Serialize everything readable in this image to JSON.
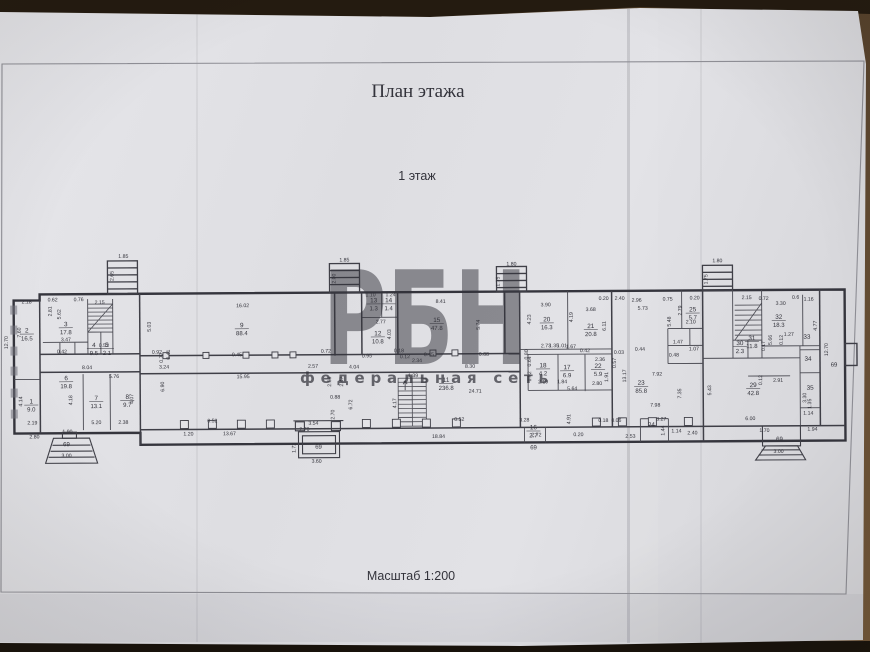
{
  "page": {
    "title": "План этажа",
    "floor_label": "1 этаж",
    "scale_label": "Масштаб 1:200"
  },
  "watermark": {
    "text": "РБН",
    "subtext": "федеральная сеть",
    "color": "#c84e4e"
  },
  "colors": {
    "ink": "#33333b",
    "wall": "#3f3f47",
    "paper": "#e3e3e7"
  },
  "plan": {
    "rooms": [
      {
        "n": "1",
        "a": "9.0",
        "x": 31,
        "y": 401
      },
      {
        "n": "2",
        "a": "16.5",
        "x": 27,
        "y": 330
      },
      {
        "n": "3",
        "a": "17.8",
        "x": 66,
        "y": 324
      },
      {
        "n": "4",
        "a": "9.5",
        "x": 94,
        "y": 345
      },
      {
        "n": "5",
        "a": "2.1",
        "x": 107,
        "y": 345
      },
      {
        "n": "6",
        "a": "19.8",
        "x": 66,
        "y": 378
      },
      {
        "n": "7",
        "a": "13.1",
        "x": 96,
        "y": 398
      },
      {
        "n": "8",
        "a": "9.7",
        "x": 127,
        "y": 397
      },
      {
        "n": "9",
        "a": "88.4",
        "x": 242,
        "y": 326
      },
      {
        "n": "11",
        "a": "236.8",
        "x": 446,
        "y": 382
      },
      {
        "n": "12",
        "a": "10.8",
        "x": 378,
        "y": 335
      },
      {
        "n": "13",
        "a": "1.3",
        "x": 374,
        "y": 302
      },
      {
        "n": "14",
        "a": "1.4",
        "x": 389,
        "y": 302
      },
      {
        "n": "15",
        "a": "47.8",
        "x": 437,
        "y": 322
      },
      {
        "n": "16",
        "a": "2.7",
        "x": 533,
        "y": 430
      },
      {
        "n": "17",
        "a": "6.9",
        "x": 567,
        "y": 370
      },
      {
        "n": "18",
        "a": "4.2",
        "x": 543,
        "y": 368
      },
      {
        "n": "20",
        "a": "16.3",
        "x": 547,
        "y": 322
      },
      {
        "n": "21",
        "a": "20.8",
        "x": 591,
        "y": 329
      },
      {
        "n": "22",
        "a": "5.9",
        "x": 598,
        "y": 369
      },
      {
        "n": "23",
        "a": "85.8",
        "x": 641,
        "y": 386
      },
      {
        "n": "24",
        "a": "",
        "x": 651,
        "y": 428
      },
      {
        "n": "25",
        "a": "5.7",
        "x": 693,
        "y": 313
      },
      {
        "n": "29",
        "a": "42.8",
        "x": 753,
        "y": 389
      },
      {
        "n": "30",
        "a": "2.3",
        "x": 740,
        "y": 347
      },
      {
        "n": "31",
        "a": "11.8",
        "x": 752,
        "y": 342
      },
      {
        "n": "32",
        "a": "18.3",
        "x": 779,
        "y": 321
      },
      {
        "n": "33",
        "a": "",
        "x": 807,
        "y": 341
      },
      {
        "n": "34",
        "a": "",
        "x": 808,
        "y": 363
      },
      {
        "n": "35",
        "a": "",
        "x": 810,
        "y": 392
      }
    ],
    "entrances": [
      {
        "t": "69",
        "x": 66,
        "y": 444
      },
      {
        "t": "69",
        "x": 318,
        "y": 448
      },
      {
        "t": "69",
        "x": 533,
        "y": 450
      },
      {
        "t": "69",
        "x": 779,
        "y": 443
      },
      {
        "t": "69",
        "x": 834,
        "y": 369
      }
    ],
    "dimensions": [
      {
        "t": "1.85",
        "x": 124,
        "y": 256
      },
      {
        "t": "2.65",
        "x": 114,
        "y": 274,
        "r": 1
      },
      {
        "t": "1.85",
        "x": 345,
        "y": 261
      },
      {
        "t": "2.00",
        "x": 336,
        "y": 278,
        "r": 1
      },
      {
        "t": "1.80",
        "x": 512,
        "y": 266
      },
      {
        "t": "1.75",
        "x": 500,
        "y": 282,
        "r": 1
      },
      {
        "t": "1.80",
        "x": 718,
        "y": 264
      },
      {
        "t": "1.75",
        "x": 708,
        "y": 281,
        "r": 1
      },
      {
        "t": "2.18",
        "x": 27,
        "y": 301
      },
      {
        "t": "0.62",
        "x": 53,
        "y": 299
      },
      {
        "t": "0.76",
        "x": 79,
        "y": 299
      },
      {
        "t": "2.15",
        "x": 100,
        "y": 302
      },
      {
        "t": "16.02",
        "x": 243,
        "y": 306
      },
      {
        "t": "8.41",
        "x": 441,
        "y": 303
      },
      {
        "t": "3.90",
        "x": 546,
        "y": 307
      },
      {
        "t": "3.68",
        "x": 591,
        "y": 312
      },
      {
        "t": "0.20",
        "x": 604,
        "y": 301
      },
      {
        "t": "2.40",
        "x": 620,
        "y": 301
      },
      {
        "t": "2.96",
        "x": 637,
        "y": 303
      },
      {
        "t": "0.75",
        "x": 668,
        "y": 302
      },
      {
        "t": "0.20",
        "x": 695,
        "y": 301
      },
      {
        "t": "2.15",
        "x": 747,
        "y": 301
      },
      {
        "t": "0.72",
        "x": 764,
        "y": 302
      },
      {
        "t": "3.30",
        "x": 781,
        "y": 307
      },
      {
        "t": "0.6",
        "x": 796,
        "y": 301
      },
      {
        "t": "1.16",
        "x": 809,
        "y": 303
      },
      {
        "t": "12.70",
        "x": 8,
        "y": 340,
        "r": 1
      },
      {
        "t": "7.60",
        "x": 21,
        "y": 330,
        "r": 1
      },
      {
        "t": "5.62",
        "x": 61,
        "y": 312,
        "r": 1
      },
      {
        "t": "2.81",
        "x": 52,
        "y": 309,
        "r": 1
      },
      {
        "t": "3.47",
        "x": 66,
        "y": 339
      },
      {
        "t": "0.42",
        "x": 62,
        "y": 351
      },
      {
        "t": "0.52",
        "x": 104,
        "y": 345
      },
      {
        "t": "5.03",
        "x": 151,
        "y": 325,
        "r": 1
      },
      {
        "t": "8.04",
        "x": 87,
        "y": 367
      },
      {
        "t": "5.76",
        "x": 114,
        "y": 376
      },
      {
        "t": "4.14",
        "x": 22,
        "y": 399,
        "r": 1
      },
      {
        "t": "4.18",
        "x": 72,
        "y": 398,
        "r": 1
      },
      {
        "t": "4.07",
        "x": 133,
        "y": 397,
        "r": 1
      },
      {
        "t": "2.19",
        "x": 32,
        "y": 422
      },
      {
        "t": "2.80",
        "x": 34,
        "y": 436
      },
      {
        "t": "5.20",
        "x": 96,
        "y": 422
      },
      {
        "t": "2.38",
        "x": 123,
        "y": 422
      },
      {
        "t": "1.90",
        "x": 67,
        "y": 431
      },
      {
        "t": "3.00",
        "x": 66,
        "y": 455
      },
      {
        "t": "0.92",
        "x": 157,
        "y": 352
      },
      {
        "t": "0.77",
        "x": 163,
        "y": 356,
        "r": 1
      },
      {
        "t": "0.41",
        "x": 170,
        "y": 353,
        "r": 1
      },
      {
        "t": "3.24",
        "x": 164,
        "y": 367
      },
      {
        "t": "6.90",
        "x": 164,
        "y": 385,
        "r": 1
      },
      {
        "t": "15.95",
        "x": 243,
        "y": 377
      },
      {
        "t": "0.45",
        "x": 237,
        "y": 355
      },
      {
        "t": "2.57",
        "x": 313,
        "y": 367
      },
      {
        "t": "0.72",
        "x": 326,
        "y": 352
      },
      {
        "t": "4.04",
        "x": 354,
        "y": 368
      },
      {
        "t": "2.68",
        "x": 331,
        "y": 381,
        "r": 1
      },
      {
        "t": "2.47",
        "x": 343,
        "y": 381,
        "r": 1
      },
      {
        "t": "0.88",
        "x": 335,
        "y": 398
      },
      {
        "t": "6.72",
        "x": 352,
        "y": 404,
        "r": 1
      },
      {
        "t": "2.70",
        "x": 334,
        "y": 414,
        "r": 1
      },
      {
        "t": "1.20",
        "x": 188,
        "y": 434
      },
      {
        "t": "13.67",
        "x": 229,
        "y": 434
      },
      {
        "t": "0.52",
        "x": 212,
        "y": 421
      },
      {
        "t": "3.54",
        "x": 313,
        "y": 424
      },
      {
        "t": "2.70",
        "x": 304,
        "y": 430
      },
      {
        "t": "1.72",
        "x": 295,
        "y": 447,
        "r": 1
      },
      {
        "t": "3.60",
        "x": 316,
        "y": 462
      },
      {
        "t": "1.10",
        "x": 371,
        "y": 296
      },
      {
        "t": "1.24",
        "x": 391,
        "y": 296
      },
      {
        "t": "2.77",
        "x": 381,
        "y": 323
      },
      {
        "t": "4.03",
        "x": 391,
        "y": 334,
        "r": 1
      },
      {
        "t": "0.95",
        "x": 367,
        "y": 357
      },
      {
        "t": "0.18",
        "x": 399,
        "y": 352
      },
      {
        "t": "0.12",
        "x": 405,
        "y": 358
      },
      {
        "t": "2.34",
        "x": 417,
        "y": 362
      },
      {
        "t": "0.45",
        "x": 429,
        "y": 356
      },
      {
        "t": "5.74",
        "x": 480,
        "y": 325,
        "r": 1
      },
      {
        "t": "0.88",
        "x": 484,
        "y": 356
      },
      {
        "t": "8.30",
        "x": 470,
        "y": 368
      },
      {
        "t": "1.39",
        "x": 413,
        "y": 377
      },
      {
        "t": "4.17",
        "x": 396,
        "y": 403,
        "r": 1
      },
      {
        "t": "24.71",
        "x": 475,
        "y": 393
      },
      {
        "t": "18.84",
        "x": 438,
        "y": 438
      },
      {
        "t": "0.52",
        "x": 459,
        "y": 421
      },
      {
        "t": "4.23",
        "x": 531,
        "y": 320,
        "r": 1
      },
      {
        "t": "4.19",
        "x": 573,
        "y": 318,
        "r": 1
      },
      {
        "t": "6.11",
        "x": 606,
        "y": 327,
        "r": 1
      },
      {
        "t": "5.73",
        "x": 643,
        "y": 311
      },
      {
        "t": "5.48",
        "x": 671,
        "y": 323,
        "r": 1
      },
      {
        "t": "2.79",
        "x": 682,
        "y": 312,
        "r": 1
      },
      {
        "t": "2.10",
        "x": 691,
        "y": 325
      },
      {
        "t": "2.73",
        "x": 546,
        "y": 348
      },
      {
        "t": "1.35",
        "x": 554,
        "y": 348
      },
      {
        "t": "1.01",
        "x": 562,
        "y": 348
      },
      {
        "t": "1.67",
        "x": 571,
        "y": 349
      },
      {
        "t": "0.80",
        "x": 528,
        "y": 355,
        "r": 1
      },
      {
        "t": "0.64",
        "x": 531,
        "y": 362,
        "r": 1
      },
      {
        "t": "1.92",
        "x": 531,
        "y": 377,
        "r": 1
      },
      {
        "t": "2.19",
        "x": 543,
        "y": 384
      },
      {
        "t": "1.84",
        "x": 562,
        "y": 384
      },
      {
        "t": "5.64",
        "x": 572,
        "y": 391
      },
      {
        "t": "0.42",
        "x": 585,
        "y": 353
      },
      {
        "t": "2.36",
        "x": 600,
        "y": 362
      },
      {
        "t": "1.91",
        "x": 608,
        "y": 378,
        "r": 1
      },
      {
        "t": "2.80",
        "x": 597,
        "y": 386
      },
      {
        "t": "0.57",
        "x": 616,
        "y": 364,
        "r": 1
      },
      {
        "t": "13.17",
        "x": 626,
        "y": 377,
        "r": 1
      },
      {
        "t": "0.03",
        "x": 619,
        "y": 355
      },
      {
        "t": "0.44",
        "x": 640,
        "y": 352
      },
      {
        "t": "7.92",
        "x": 657,
        "y": 377
      },
      {
        "t": "7.98",
        "x": 655,
        "y": 408
      },
      {
        "t": "7.35",
        "x": 681,
        "y": 395,
        "r": 1
      },
      {
        "t": "1.47",
        "x": 678,
        "y": 345
      },
      {
        "t": "1.07",
        "x": 694,
        "y": 352
      },
      {
        "t": "0.48",
        "x": 674,
        "y": 358
      },
      {
        "t": "3.28",
        "x": 524,
        "y": 422
      },
      {
        "t": "2.72",
        "x": 536,
        "y": 437
      },
      {
        "t": "4.91",
        "x": 570,
        "y": 420,
        "r": 1
      },
      {
        "t": "0.18",
        "x": 603,
        "y": 423
      },
      {
        "t": "0.06",
        "x": 616,
        "y": 423
      },
      {
        "t": "2.53",
        "x": 630,
        "y": 439
      },
      {
        "t": "3.27",
        "x": 661,
        "y": 422
      },
      {
        "t": "1.44",
        "x": 664,
        "y": 432,
        "r": 1
      },
      {
        "t": "1.14",
        "x": 676,
        "y": 434
      },
      {
        "t": "2.40",
        "x": 692,
        "y": 436
      },
      {
        "t": "0.20",
        "x": 578,
        "y": 437
      },
      {
        "t": "1.27",
        "x": 789,
        "y": 338
      },
      {
        "t": "0.12",
        "x": 783,
        "y": 342,
        "r": 1
      },
      {
        "t": "5.66",
        "x": 772,
        "y": 342,
        "r": 1
      },
      {
        "t": "0.17",
        "x": 765,
        "y": 348,
        "r": 1
      },
      {
        "t": "4.77",
        "x": 817,
        "y": 328,
        "r": 1
      },
      {
        "t": "12.70",
        "x": 828,
        "y": 352,
        "r": 1
      },
      {
        "t": "5.43",
        "x": 711,
        "y": 392,
        "r": 1
      },
      {
        "t": "0.12",
        "x": 762,
        "y": 382,
        "r": 1
      },
      {
        "t": "2.91",
        "x": 778,
        "y": 384
      },
      {
        "t": "6.00",
        "x": 750,
        "y": 422
      },
      {
        "t": "3.30",
        "x": 806,
        "y": 400,
        "r": 1
      },
      {
        "t": "1.35",
        "x": 811,
        "y": 406,
        "r": 1
      },
      {
        "t": "1.14",
        "x": 808,
        "y": 417
      },
      {
        "t": "1.94",
        "x": 812,
        "y": 433
      },
      {
        "t": "1.70",
        "x": 764,
        "y": 434
      },
      {
        "t": "3.00",
        "x": 778,
        "y": 455
      }
    ]
  }
}
